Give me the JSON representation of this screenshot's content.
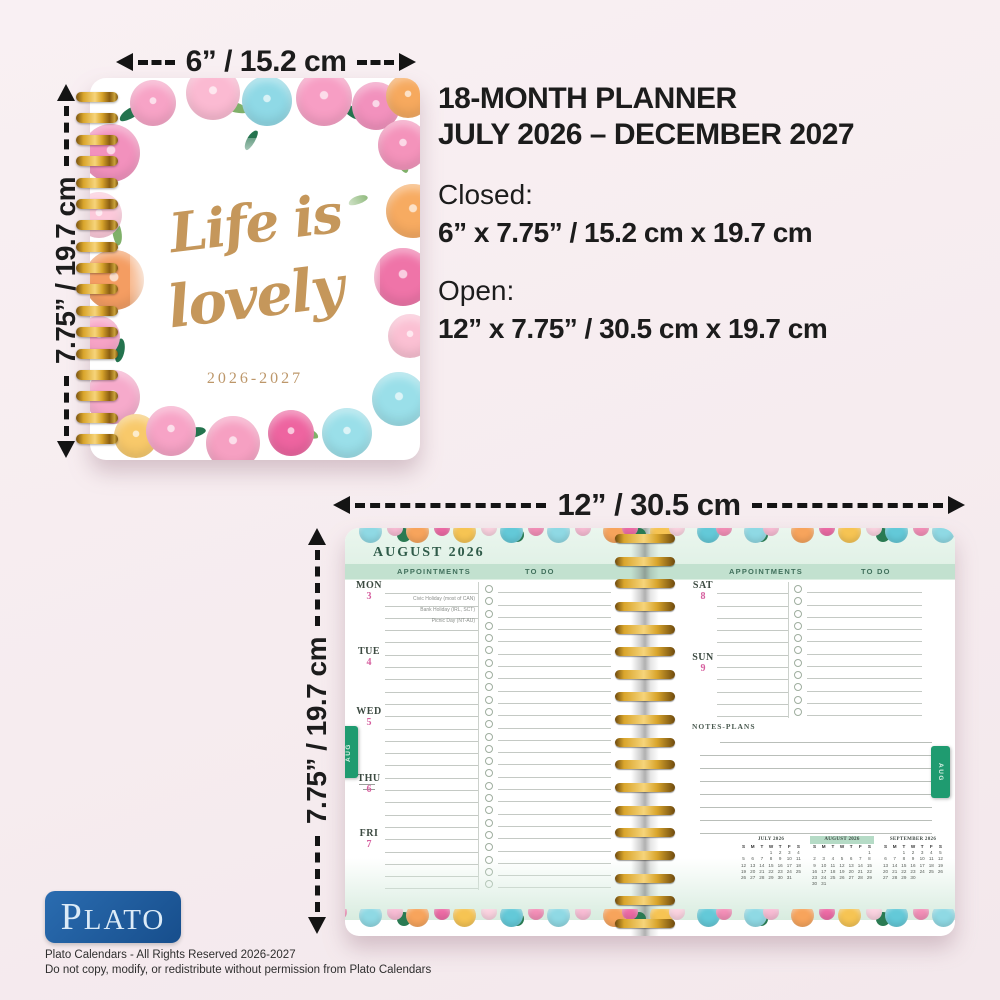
{
  "colors": {
    "background": "#f7edf0",
    "brand_blue": "#1d5c9e",
    "gold_script": "#c5975b",
    "mint_header": "#e7f4eb",
    "mint_band": "#c2e1cf",
    "tab_green": "#1f9b70",
    "day_number_pink": "#d65f9f",
    "text_black": "#1c1c1c"
  },
  "closed_view": {
    "width_label": "6” / 15.2 cm",
    "height_label": "7.75” / 19.7 cm",
    "cover": {
      "script_line1": "Life is",
      "script_line2": "lovely",
      "years": "2026-2027"
    }
  },
  "product_info": {
    "title_line1": "18-MONTH PLANNER",
    "title_line2": "JULY 2026 – DECEMBER 2027",
    "closed_label": "Closed:",
    "closed_dimensions": "6” x 7.75” / 15.2 cm x 19.7 cm",
    "open_label": "Open:",
    "open_dimensions": "12” x 7.75” / 30.5 cm x 19.7 cm"
  },
  "open_view": {
    "width_label": "12” / 30.5 cm",
    "height_label": "7.75” / 19.7 cm",
    "month_title": "AUGUST 2026",
    "left_page": {
      "appointments_header": "APPOINTMENTS",
      "todo_header": "TO DO",
      "tab_label": "AUG",
      "days": [
        {
          "name": "MON",
          "number": "3",
          "holiday_notes": [
            "Civic Holiday (most of CAN)",
            "Bank Holiday (IRL, SCT)",
            "Picnic Day (NT-AU)"
          ]
        },
        {
          "name": "TUE",
          "number": "4",
          "holiday_notes": []
        },
        {
          "name": "WED",
          "number": "5",
          "holiday_notes": []
        },
        {
          "name": "THU",
          "number": "6",
          "holiday_notes": []
        },
        {
          "name": "FRI",
          "number": "7",
          "holiday_notes": []
        }
      ]
    },
    "right_page": {
      "appointments_header": "APPOINTMENTS",
      "todo_header": "TO DO",
      "tab_label": "AUG",
      "notes_label": "NOTES-PLANS",
      "days": [
        {
          "name": "SAT",
          "number": "8"
        },
        {
          "name": "SUN",
          "number": "9"
        }
      ],
      "mini_calendars": [
        {
          "title": "JULY 2026",
          "highlighted": false,
          "dow": [
            "S",
            "M",
            "T",
            "W",
            "T",
            "F",
            "S"
          ],
          "weeks": [
            [
              "",
              "",
              "",
              "1",
              "2",
              "3",
              "4"
            ],
            [
              "5",
              "6",
              "7",
              "8",
              "9",
              "10",
              "11"
            ],
            [
              "12",
              "13",
              "14",
              "15",
              "16",
              "17",
              "18"
            ],
            [
              "19",
              "20",
              "21",
              "22",
              "23",
              "24",
              "25"
            ],
            [
              "26",
              "27",
              "28",
              "29",
              "30",
              "31",
              ""
            ]
          ]
        },
        {
          "title": "AUGUST 2026",
          "highlighted": true,
          "dow": [
            "S",
            "M",
            "T",
            "W",
            "T",
            "F",
            "S"
          ],
          "weeks": [
            [
              "",
              "",
              "",
              "",
              "",
              "",
              "1"
            ],
            [
              "2",
              "3",
              "4",
              "5",
              "6",
              "7",
              "8"
            ],
            [
              "9",
              "10",
              "11",
              "12",
              "13",
              "14",
              "15"
            ],
            [
              "16",
              "17",
              "18",
              "19",
              "20",
              "21",
              "22"
            ],
            [
              "23",
              "24",
              "25",
              "26",
              "27",
              "28",
              "29"
            ],
            [
              "30",
              "31",
              "",
              "",
              "",
              "",
              ""
            ]
          ]
        },
        {
          "title": "SEPTEMBER 2026",
          "highlighted": false,
          "dow": [
            "S",
            "M",
            "T",
            "W",
            "T",
            "F",
            "S"
          ],
          "weeks": [
            [
              "",
              "",
              "1",
              "2",
              "3",
              "4",
              "5"
            ],
            [
              "6",
              "7",
              "8",
              "9",
              "10",
              "11",
              "12"
            ],
            [
              "13",
              "14",
              "15",
              "16",
              "17",
              "18",
              "19"
            ],
            [
              "20",
              "21",
              "22",
              "23",
              "24",
              "25",
              "26"
            ],
            [
              "27",
              "28",
              "29",
              "30",
              "",
              "",
              ""
            ]
          ]
        }
      ]
    }
  },
  "footer": {
    "logo_text": "PLATO",
    "copyright_line1": "Plato Calendars - All Rights Reserved 2026-2027",
    "copyright_line2": "Do not copy, modify, or redistribute without permission from Plato Calendars"
  }
}
